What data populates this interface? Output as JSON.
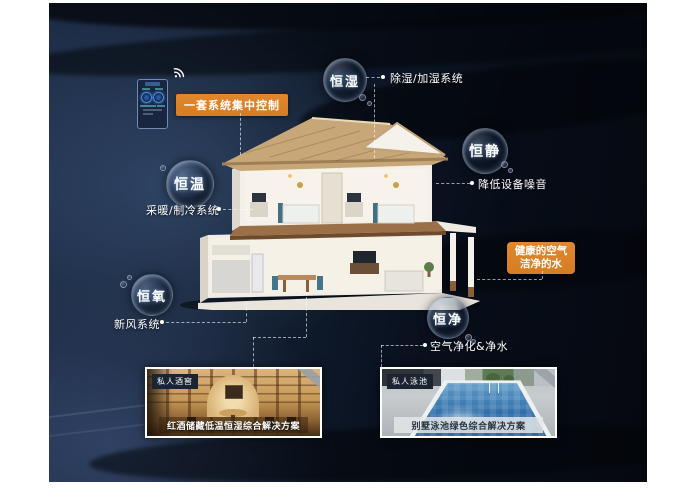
{
  "control_label": "一套系统集中控制",
  "healthy_box": {
    "line1": "健康的空气",
    "line2": "洁净的水"
  },
  "bubbles": {
    "humidity": {
      "text": "恒湿",
      "note": "除湿/加湿系统"
    },
    "quiet": {
      "text": "恒静",
      "note": "降低设备噪音"
    },
    "temperature": {
      "text": "恒温",
      "note": "采暖/制冷系统"
    },
    "oxygen": {
      "text": "恒氧",
      "note": "新风系统"
    },
    "purity": {
      "text": "恒净",
      "note": "空气净化&净水"
    }
  },
  "panels": {
    "wine": {
      "badge": "私人酒窖",
      "caption": "红酒储藏低温恒湿综合解决方案"
    },
    "pool": {
      "badge": "私人泳池",
      "caption": "别墅泳池绿色综合解决方案"
    }
  },
  "icons": {
    "wifi": "wifi-icon"
  },
  "colors": {
    "accent_orange": "#DD8329",
    "background_navy": "#0d1726",
    "text": "#FFFFFF"
  }
}
